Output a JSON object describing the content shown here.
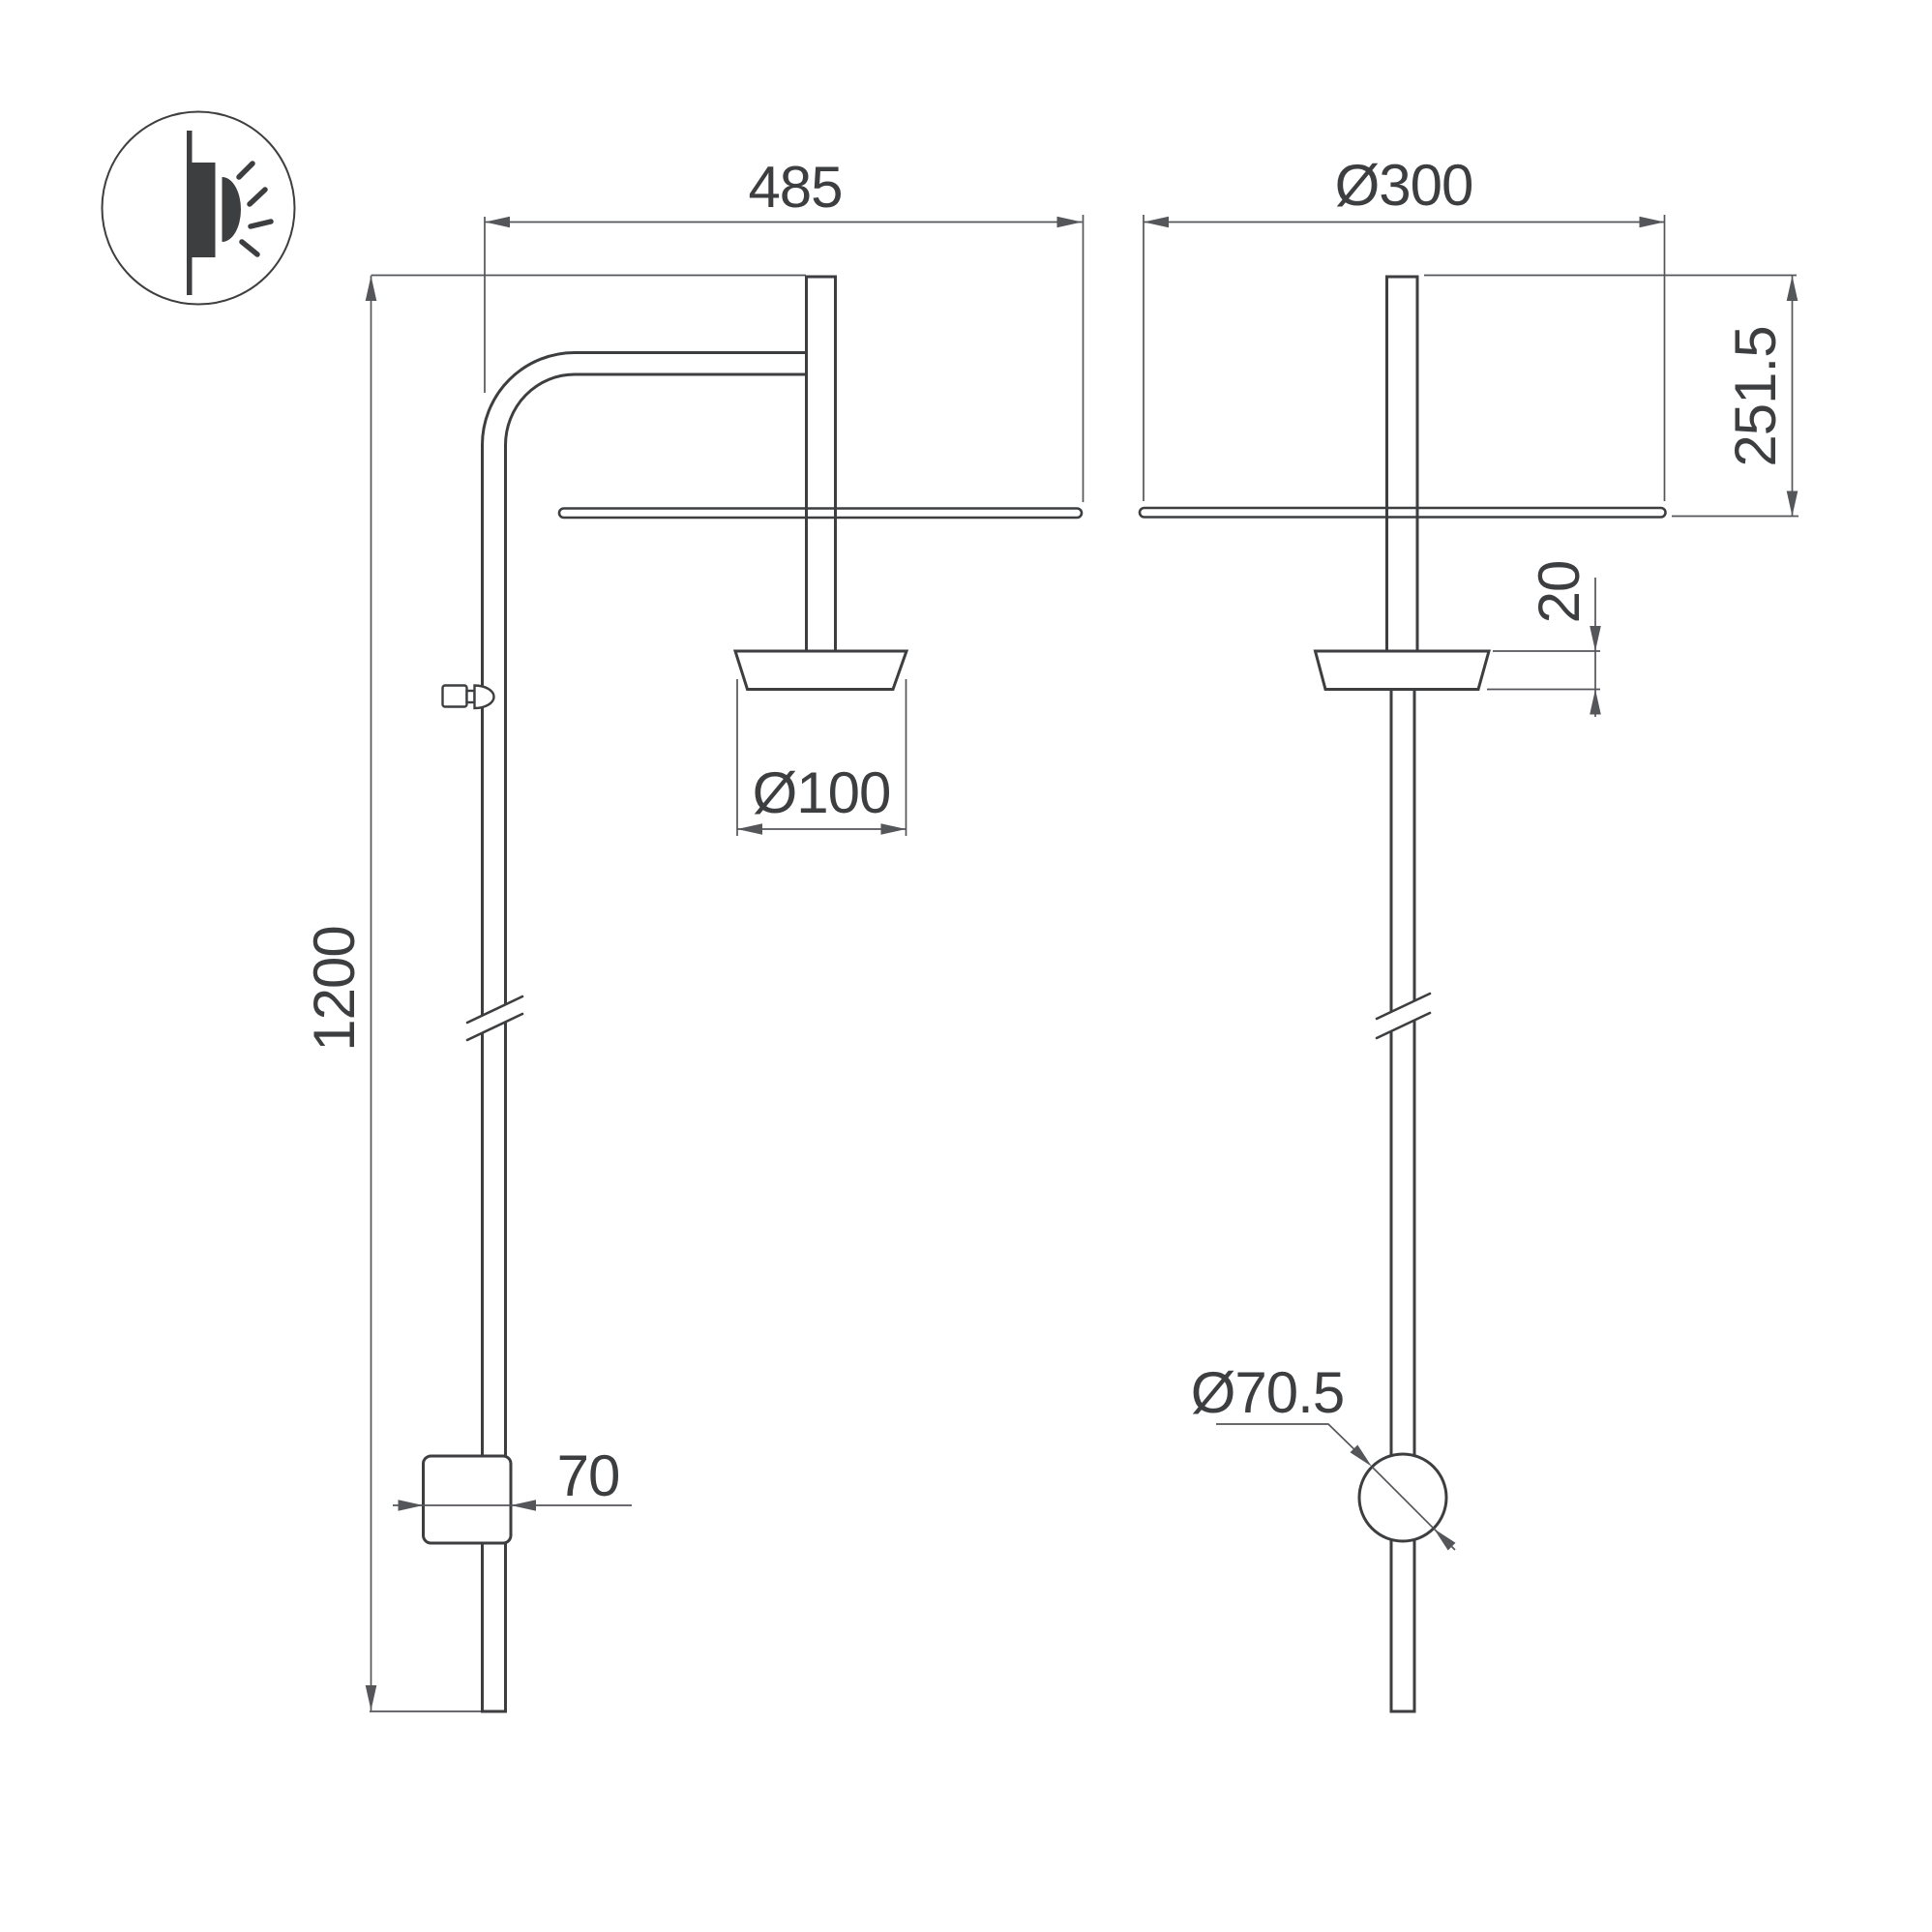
{
  "drawing": {
    "icon_name": "wall-mounted-light-icon",
    "dims": {
      "width": "485",
      "height": "1200",
      "head_diameter": "Ø100",
      "box_width": "70",
      "disc_diameter": "Ø300",
      "top_to_disc": "251.5",
      "head_height": "20",
      "knob_diameter": "Ø70.5"
    },
    "colors": {
      "line": "#3d3e40",
      "dimension": "#54565a",
      "background": "#ffffff"
    }
  }
}
